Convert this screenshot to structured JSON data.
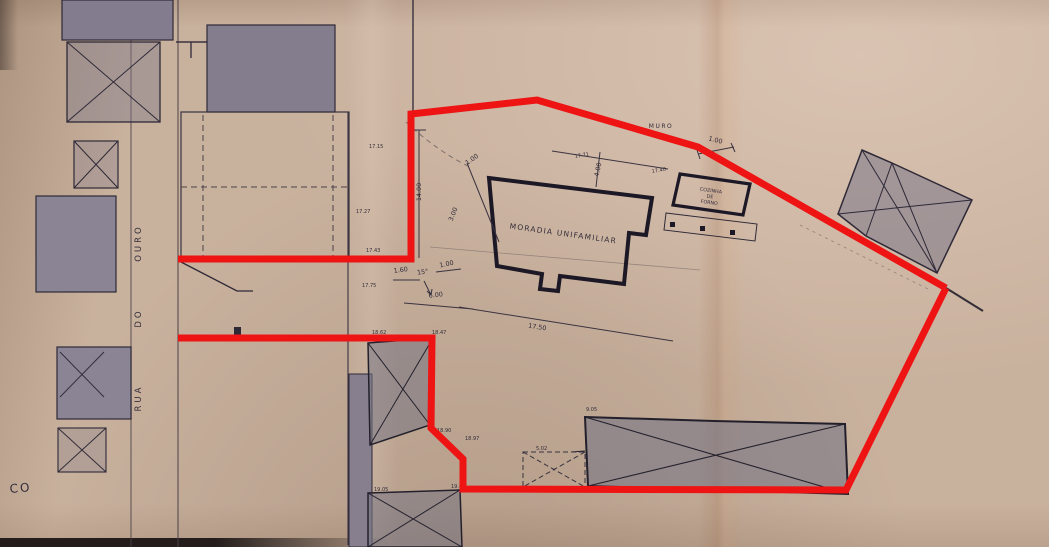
{
  "labels": {
    "house": "MORADIA UNIFAMILIAR",
    "kitchen": [
      "COZINHA",
      "DE",
      "FORNO"
    ],
    "wall": "MURO",
    "street": [
      "RUA",
      "DO",
      "OURO"
    ],
    "corner_fragment": "CO"
  },
  "dimensions": [
    {
      "text": "14.00"
    },
    {
      "text": "1.00"
    },
    {
      "text": "3.00"
    },
    {
      "text": "1.60"
    },
    {
      "text": "15°"
    },
    {
      "text": "1.00"
    },
    {
      "text": "6.00"
    },
    {
      "text": "17.50"
    },
    {
      "text": "4.00"
    },
    {
      "text": "1.00"
    }
  ],
  "pencil_notes": [
    {
      "text": "17.71"
    },
    {
      "text": "17.40"
    },
    {
      "text": "17.15"
    },
    {
      "text": "17.27"
    },
    {
      "text": "17.43"
    },
    {
      "text": "17.75"
    },
    {
      "text": "18.62"
    },
    {
      "text": "18.47"
    },
    {
      "text": "18.90"
    },
    {
      "text": "18.97"
    },
    {
      "text": "19.05"
    },
    {
      "text": "19.08"
    },
    {
      "text": "9.05"
    },
    {
      "text": "5.02"
    }
  ],
  "colors": {
    "boundary_red": "#ee1414",
    "ink": "#2e2836",
    "building_fill": "#8a8292",
    "paper": "#c8b19d"
  }
}
